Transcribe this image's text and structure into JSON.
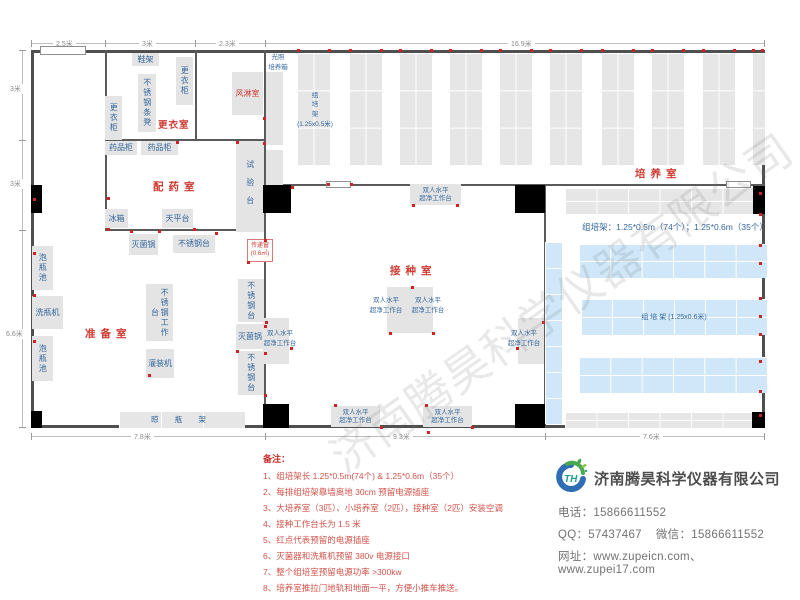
{
  "watermark_text": "济南腾昊科学仪器有限公司",
  "company": {
    "name": "济南腾昊科学仪器有限公司",
    "logo_text": "TH",
    "phone_label": "电话：",
    "phone": "15866611552",
    "qq_label": "QQ：",
    "qq": "57437467",
    "wechat_label": "微信：",
    "wechat": "15866611552",
    "web_label": "网址：",
    "websites": "www.zupeicn.com、www.zupei17.com"
  },
  "notes": {
    "title": "备注：",
    "items": [
      "1、组培架长 1.25*0.5m(74个) & 1.25*0.6m（35个）",
      "2、每排组培架靠墙离地 30cm 预留电源插座",
      "3、大培养室（3匹）、小培养室（2匹），接种室（2匹）安装空调",
      "4、接种工作台长为 1.5 米",
      "5、红点代表预留的电源插座",
      "6、灭菌器和洗瓶机预留 380v 电源接口",
      "7、整个组培室预留电源功率 >300kw",
      "8、培养室推拉门地轨和地面一平，方便小推车推送。"
    ]
  },
  "plan": {
    "bench_label": "双人水平\n超净工作台",
    "rack_note": "组培架：1.25*0.5m（74个）；1.25*0.6m（35个）",
    "walls": [
      [
        105,
        50,
        2,
        181
      ],
      [
        195,
        50,
        2,
        91
      ],
      [
        264,
        50,
        2,
        378
      ],
      [
        105,
        139,
        161,
        2
      ],
      [
        105,
        229,
        161,
        2
      ],
      [
        264,
        184,
        501,
        2
      ],
      [
        544,
        186,
        2,
        242
      ]
    ],
    "openings": [
      [
        40,
        46,
        46,
        9
      ],
      [
        326,
        181,
        25,
        7
      ],
      [
        726,
        181,
        25,
        7
      ]
    ],
    "rooms": [
      {
        "l": "更衣室",
        "x": 158,
        "y": 117,
        "fs": 9.5,
        "ls": 1
      },
      {
        "l": "配药室",
        "x": 153,
        "y": 179,
        "fs": 10.5,
        "ls": 5
      },
      {
        "l": "准备室",
        "x": 85,
        "y": 326,
        "fs": 10.5,
        "ls": 5
      },
      {
        "l": "接种室",
        "x": 390,
        "y": 263,
        "fs": 10.5,
        "ls": 5
      },
      {
        "l": "培养室",
        "x": 635,
        "y": 166,
        "fs": 10.5,
        "ls": 5
      }
    ],
    "equipment": [
      {
        "l": "鞋架",
        "x": 132,
        "y": 53,
        "w": 27,
        "h": 13
      },
      {
        "l": "更衣柜",
        "x": 176,
        "y": 57,
        "w": 17,
        "h": 48,
        "v": 1
      },
      {
        "l": "不锈钢条凳",
        "x": 138,
        "y": 74,
        "w": 18,
        "h": 58,
        "v": 1
      },
      {
        "l": "更衣柜",
        "x": 105,
        "y": 96,
        "w": 17,
        "h": 44,
        "v": 1
      },
      {
        "l": "药品柜",
        "x": 105,
        "y": 141,
        "w": 32,
        "h": 14
      },
      {
        "l": "药品柜",
        "x": 141,
        "y": 141,
        "w": 37,
        "h": 14
      },
      {
        "l": "试验台",
        "x": 236,
        "y": 141,
        "w": 28,
        "h": 91,
        "v": 1,
        "sp": 1
      },
      {
        "l": "冰箱",
        "x": 105,
        "y": 209,
        "w": 23,
        "h": 19
      },
      {
        "l": "天平台",
        "x": 162,
        "y": 209,
        "w": 31,
        "h": 19
      },
      {
        "l": "灭菌锅",
        "x": 129,
        "y": 234,
        "w": 29,
        "h": 21
      },
      {
        "l": "不锈钢台",
        "x": 173,
        "y": 235,
        "w": 42,
        "h": 18
      },
      {
        "l": "泡瓶池",
        "x": 32,
        "y": 246,
        "w": 21,
        "h": 44,
        "v": 1
      },
      {
        "l": "洗瓶机",
        "x": 32,
        "y": 296,
        "w": 31,
        "h": 33
      },
      {
        "l": "泡瓶池",
        "x": 32,
        "y": 336,
        "w": 21,
        "h": 45,
        "v": 1
      },
      {
        "l": "不锈钢工作台",
        "x": 146,
        "y": 284,
        "w": 27,
        "h": 57,
        "v": 1
      },
      {
        "l": "灌装机",
        "x": 146,
        "y": 349,
        "w": 28,
        "h": 29
      },
      {
        "l": "不锈钢台",
        "x": 238,
        "y": 279,
        "w": 26,
        "h": 43,
        "v": 1
      },
      {
        "l": "灭菌锅",
        "x": 236,
        "y": 324,
        "w": 28,
        "h": 25
      },
      {
        "l": "不锈钢台",
        "x": 238,
        "y": 351,
        "w": 26,
        "h": 44,
        "v": 1
      },
      {
        "l": "风淋室",
        "x": 232,
        "y": 72,
        "w": 31,
        "h": 43,
        "k": "rb"
      },
      {
        "l": "",
        "x": 266,
        "y": 72,
        "w": 17,
        "h": 73,
        "k": "pb"
      },
      {
        "l": "",
        "x": 266,
        "y": 150,
        "w": 17,
        "h": 35,
        "k": "pb"
      },
      {
        "l": "",
        "x": 387,
        "y": 287,
        "w": 23,
        "h": 46,
        "k": "pb"
      },
      {
        "l": "",
        "x": 410,
        "y": 287,
        "w": 23,
        "h": 46,
        "k": "pb"
      },
      {
        "l": "",
        "x": 263,
        "y": 318,
        "w": 26,
        "h": 46,
        "k": "pb"
      },
      {
        "l": "",
        "x": 518,
        "y": 318,
        "w": 26,
        "h": 46,
        "k": "pb"
      },
      {
        "l": "光照\n培养箱",
        "x": 264,
        "y": 53,
        "w": 28,
        "h": 20,
        "k": "bt"
      },
      {
        "l": "组\n培\n架\n(1.25x0.5米)",
        "x": 295,
        "y": 80,
        "w": 40,
        "h": 60,
        "k": "bt"
      },
      {
        "l": "传递窗\n(0.6㎡)",
        "x": 247,
        "y": 239,
        "w": 26,
        "h": 23,
        "k": "tw"
      }
    ],
    "bench_boxes": [
      {
        "x": 410,
        "y": 184,
        "w": 51,
        "h": 21
      },
      {
        "x": 331,
        "y": 406,
        "w": 49,
        "h": 21
      },
      {
        "x": 423,
        "y": 406,
        "w": 49,
        "h": 21
      }
    ],
    "bench_texts": [
      {
        "x": 364,
        "y": 296,
        "w": 44
      },
      {
        "x": 406,
        "y": 296,
        "w": 44
      },
      {
        "x": 258,
        "y": 329,
        "w": 44
      },
      {
        "x": 502,
        "y": 329,
        "w": 44
      }
    ],
    "vracks": [
      {
        "x": 297,
        "y": 53,
        "w": 33,
        "h": 112
      },
      {
        "x": 349,
        "y": 53,
        "w": 33,
        "h": 112
      },
      {
        "x": 399,
        "y": 53,
        "w": 33,
        "h": 112
      },
      {
        "x": 449,
        "y": 53,
        "w": 33,
        "h": 112
      },
      {
        "x": 499,
        "y": 53,
        "w": 33,
        "h": 112
      },
      {
        "x": 549,
        "y": 53,
        "w": 33,
        "h": 112
      },
      {
        "x": 601,
        "y": 53,
        "w": 33,
        "h": 112
      },
      {
        "x": 651,
        "y": 53,
        "w": 33,
        "h": 112
      },
      {
        "x": 702,
        "y": 53,
        "w": 33,
        "h": 112
      },
      {
        "x": 752,
        "y": 53,
        "w": 13,
        "h": 112,
        "c": 1
      },
      {
        "x": 545,
        "y": 242,
        "w": 17,
        "h": 182,
        "b": 1,
        "c": 1,
        "r": 7
      }
    ],
    "hracks": [
      {
        "x": 565,
        "y": 188,
        "w": 189,
        "h": 26
      },
      {
        "x": 565,
        "y": 412,
        "w": 189,
        "h": 16
      },
      {
        "x": 579,
        "y": 244,
        "w": 188,
        "h": 34,
        "b": 1
      },
      {
        "x": 581,
        "y": 299,
        "w": 186,
        "h": 36,
        "b": 1,
        "l": "组  培  架 (1.25x0.6米)"
      },
      {
        "x": 579,
        "y": 357,
        "w": 188,
        "h": 36,
        "b": 1
      },
      {
        "x": 119,
        "y": 411,
        "w": 126,
        "h": 17,
        "c": 3,
        "r": 1,
        "l": "晾 瓶 架",
        "wide": 1
      }
    ],
    "rack_note_pos": {
      "x": 575,
      "y": 221,
      "w": 200
    },
    "doors": [
      [
        31,
        185,
        11,
        28
      ],
      [
        263,
        185,
        28,
        28
      ],
      [
        515,
        185,
        30,
        28
      ],
      [
        753,
        186,
        12,
        28
      ],
      [
        31,
        411,
        11,
        17
      ],
      [
        263,
        404,
        26,
        24
      ],
      [
        515,
        404,
        30,
        24
      ],
      [
        752,
        412,
        13,
        16
      ]
    ],
    "dots": [
      [
        297,
        49
      ],
      [
        328,
        49
      ],
      [
        349,
        49
      ],
      [
        380,
        49
      ],
      [
        399,
        49
      ],
      [
        430,
        49
      ],
      [
        449,
        49
      ],
      [
        480,
        49
      ],
      [
        499,
        49
      ],
      [
        530,
        49
      ],
      [
        549,
        49
      ],
      [
        580,
        49
      ],
      [
        601,
        49
      ],
      [
        632,
        49
      ],
      [
        651,
        49
      ],
      [
        682,
        49
      ],
      [
        702,
        49
      ],
      [
        733,
        49
      ],
      [
        752,
        49
      ],
      [
        761,
        49
      ],
      [
        759,
        192
      ],
      [
        759,
        213
      ],
      [
        759,
        244
      ],
      [
        759,
        262
      ],
      [
        759,
        297
      ],
      [
        759,
        315
      ],
      [
        759,
        333
      ],
      [
        759,
        360
      ],
      [
        759,
        390
      ],
      [
        759,
        414
      ],
      [
        33,
        198
      ],
      [
        33,
        252
      ],
      [
        33,
        294
      ],
      [
        33,
        340
      ],
      [
        107,
        197
      ],
      [
        107,
        228
      ],
      [
        130,
        230
      ],
      [
        158,
        230
      ],
      [
        193,
        228
      ],
      [
        215,
        232
      ],
      [
        176,
        141
      ],
      [
        236,
        141
      ],
      [
        263,
        117
      ],
      [
        263,
        142
      ],
      [
        264,
        239
      ],
      [
        247,
        261
      ],
      [
        291,
        186
      ],
      [
        327,
        183
      ],
      [
        350,
        183
      ],
      [
        412,
        204
      ],
      [
        456,
        204
      ],
      [
        389,
        332
      ],
      [
        432,
        332
      ],
      [
        411,
        286
      ],
      [
        265,
        321
      ],
      [
        290,
        347
      ],
      [
        516,
        347
      ],
      [
        542,
        321
      ],
      [
        334,
        404
      ],
      [
        380,
        426
      ],
      [
        425,
        404
      ],
      [
        471,
        426
      ],
      [
        427,
        431
      ],
      [
        148,
        374
      ],
      [
        264,
        325
      ],
      [
        264,
        352
      ],
      [
        264,
        394
      ],
      [
        236,
        350
      ]
    ],
    "dims": {
      "lines": [
        {
          "x": 31,
          "y": 43,
          "w": 734,
          "v": 0
        },
        {
          "x": 22,
          "y": 50,
          "h": 378,
          "v": 1
        },
        {
          "x": 31,
          "y": 436,
          "w": 734,
          "v": 0
        }
      ],
      "ticks": [
        {
          "x": 31,
          "y": 40,
          "v": 1
        },
        {
          "x": 105,
          "y": 40,
          "v": 1
        },
        {
          "x": 195,
          "y": 40,
          "v": 1
        },
        {
          "x": 265,
          "y": 40,
          "v": 1
        },
        {
          "x": 764,
          "y": 40,
          "v": 1
        },
        {
          "x": 19,
          "y": 50,
          "v": 0
        },
        {
          "x": 19,
          "y": 140,
          "v": 0
        },
        {
          "x": 19,
          "y": 230,
          "v": 0
        },
        {
          "x": 19,
          "y": 427,
          "v": 0
        },
        {
          "x": 31,
          "y": 433,
          "v": 1
        },
        {
          "x": 265,
          "y": 433,
          "v": 1
        },
        {
          "x": 545,
          "y": 433,
          "v": 1
        },
        {
          "x": 764,
          "y": 433,
          "v": 1
        }
      ],
      "labels": [
        {
          "t": "2.5米",
          "x": 53,
          "y": 39
        },
        {
          "t": "3米",
          "x": 139,
          "y": 39
        },
        {
          "t": "2.3米",
          "x": 216,
          "y": 39
        },
        {
          "t": "16.9米",
          "x": 508,
          "y": 39
        },
        {
          "t": "3米",
          "x": 7,
          "y": 84
        },
        {
          "t": "3米",
          "x": 7,
          "y": 179
        },
        {
          "t": "6.6米",
          "x": 3,
          "y": 329
        },
        {
          "t": "7.8米",
          "x": 131,
          "y": 432
        },
        {
          "t": "9.3米",
          "x": 390,
          "y": 432
        },
        {
          "t": "7.6米",
          "x": 640,
          "y": 432
        }
      ]
    }
  }
}
